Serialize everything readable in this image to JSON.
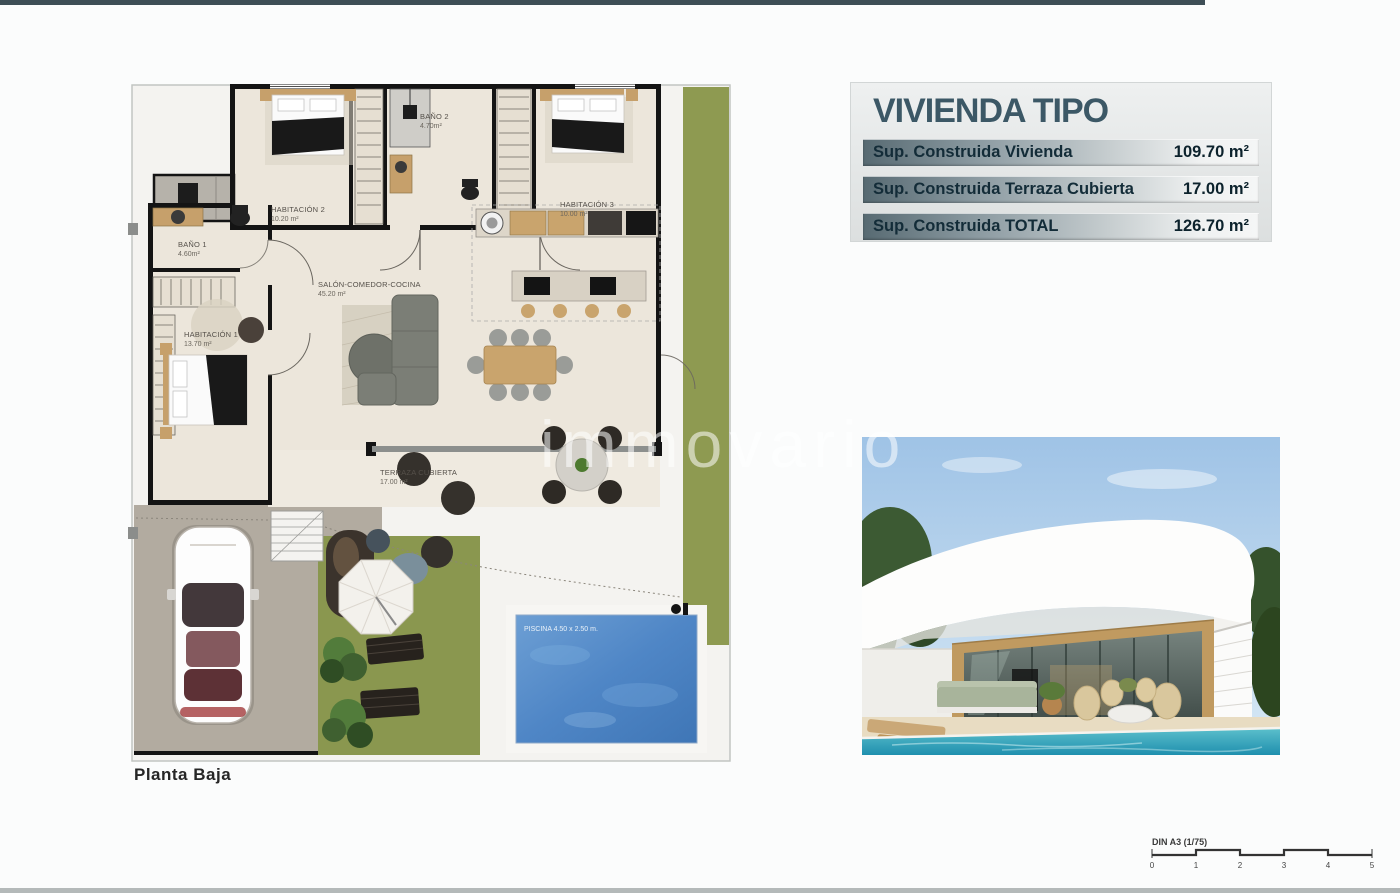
{
  "page": {
    "watermark": "immovario",
    "top_bar_color": "#3e4e56",
    "bottom_bar_color": "#b4b9b9"
  },
  "plan": {
    "caption": "Planta Baja",
    "rooms": [
      {
        "name": "HABITACIÓN 2",
        "area": "10.20 m²"
      },
      {
        "name": "BAÑO 2",
        "area": "4.70m²"
      },
      {
        "name": "HABITACIÓN 3",
        "area": "10.00 m²"
      },
      {
        "name": "BAÑO 1",
        "area": "4.60m²"
      },
      {
        "name": "SALÓN-COMEDOR-COCINA",
        "area": "45.20 m²"
      },
      {
        "name": "HABITACIÓN 1",
        "area": "13.70 m²"
      },
      {
        "name": "TERRAZA CUBIERTA",
        "area": "17.00 m²"
      }
    ],
    "pool_label": "PISCINA 4.50 x 2.50 m.",
    "colors": {
      "grass": "#8e9a51",
      "floor": "#ece6db",
      "pool": "#4f86c6",
      "walls": "#141414",
      "driveway": "#b2aba0"
    }
  },
  "info_panel": {
    "title": "VIVIENDA TIPO",
    "title_color": "#3c5866",
    "rows": [
      {
        "label": "Sup. Construida Vivienda",
        "value": "109.70 m²"
      },
      {
        "label": "Sup. Construida Terraza Cubierta",
        "value": "17.00 m²"
      },
      {
        "label": "Sup. Construida TOTAL",
        "value": "126.70 m²"
      }
    ]
  },
  "scale_bar": {
    "label": "DIN A3 (1/75)",
    "ticks": [
      "0",
      "1",
      "2",
      "3",
      "4",
      "5"
    ]
  }
}
